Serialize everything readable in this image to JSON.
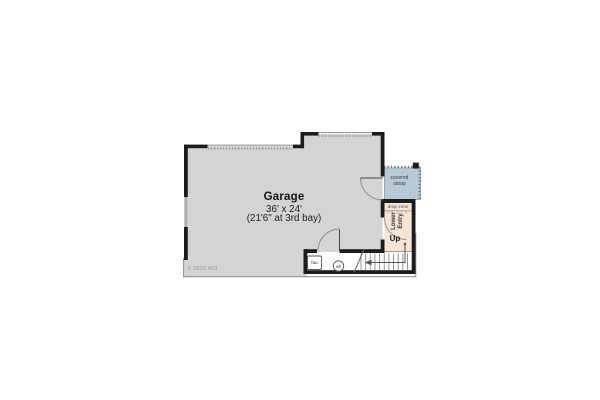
{
  "rooms": {
    "garage": {
      "name": "Garage",
      "size": "36' x 24'",
      "note": "(21'6\" at 3rd bay)"
    },
    "covered_stoop": {
      "name": "covered\nstoop"
    },
    "drop_zone": {
      "name": "drop zone"
    },
    "lower_entry": {
      "name": "Lower\nEntry"
    },
    "stairs": {
      "direction_label": "Up"
    },
    "utility": {
      "fau_label": "fau",
      "water_heater_label": "wh"
    }
  },
  "copyright": "© 2025 ADI",
  "colors": {
    "wall": "#1c1c1c",
    "garage_fill": "#d4d4d4",
    "stoop_fill": "#b7ccd7",
    "entry_fill": "#f8e4d2",
    "line": "#8a8a8a"
  }
}
